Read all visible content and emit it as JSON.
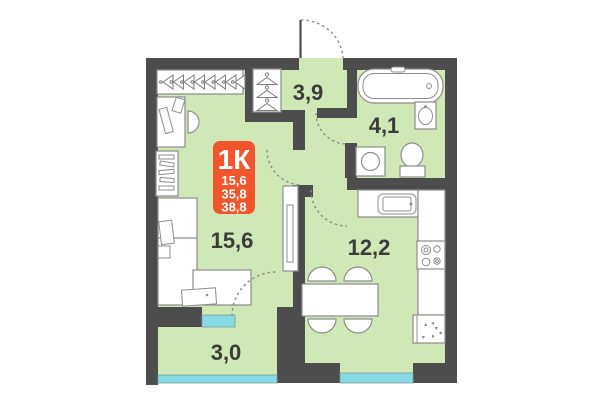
{
  "plan": {
    "badge": {
      "type_label": "1К",
      "area_line1": "15,6",
      "area_line2": "35,8",
      "area_line3": "38,8"
    },
    "rooms": {
      "hall": {
        "label": "3,9"
      },
      "bathroom": {
        "label": "4,1"
      },
      "living": {
        "label": "15,6"
      },
      "kitchen": {
        "label": "12,2"
      },
      "balcony": {
        "label": "3,0"
      }
    },
    "colors": {
      "walls": "#4D4D4D",
      "floor": "#D0E7B6",
      "windows": "#87D9E3",
      "badge": "#F0552D",
      "labels": "#3B3B3B"
    }
  }
}
